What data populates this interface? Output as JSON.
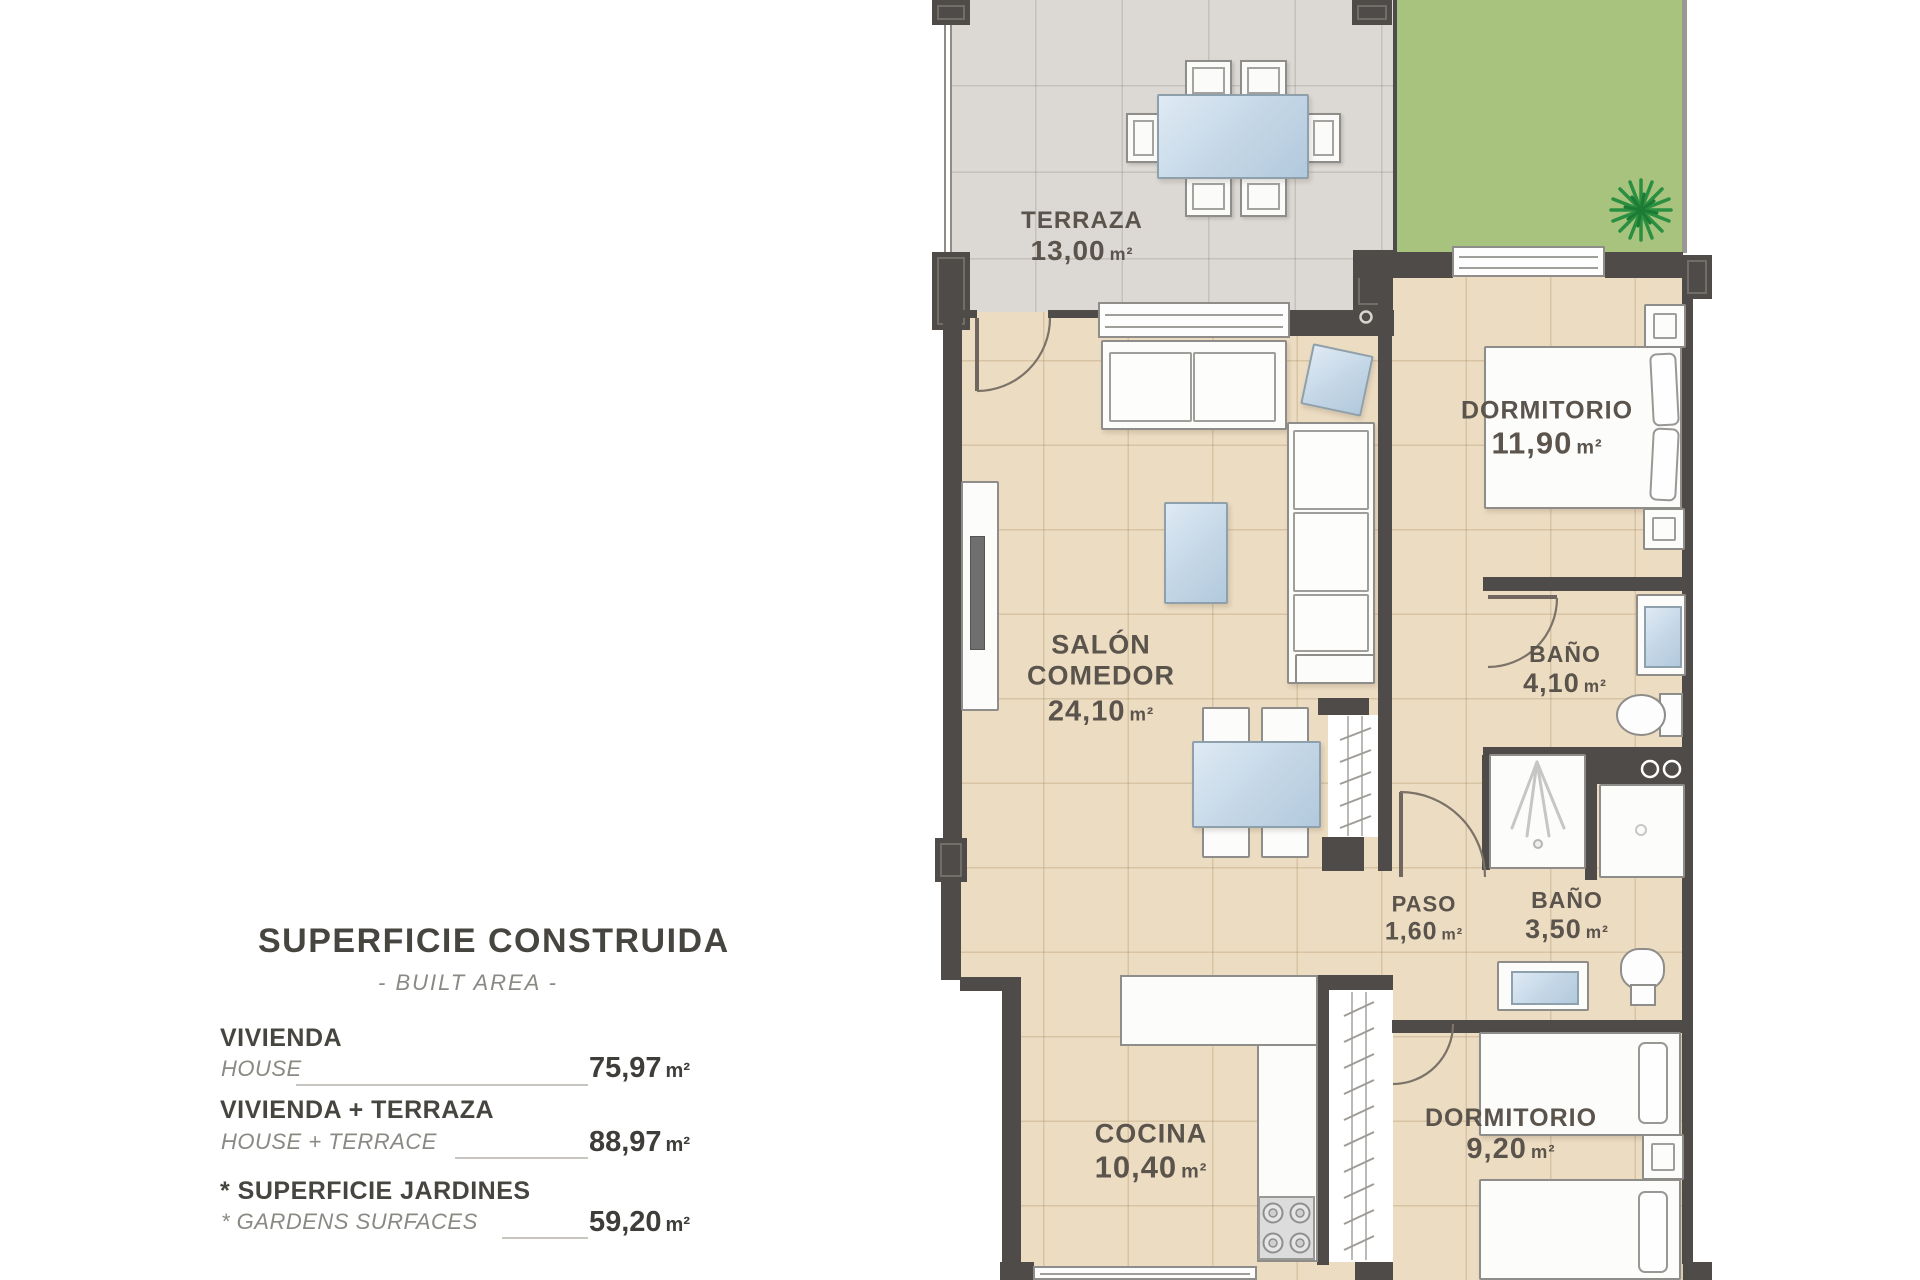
{
  "legend": {
    "title": "SUPERFICIE CONSTRUIDA",
    "subtitle": "- BUILT AREA -",
    "rows": [
      {
        "label_es": "VIVIENDA",
        "label_en": "HOUSE",
        "value": "75,97",
        "unit": "m²"
      },
      {
        "label_es": "VIVIENDA + TERRAZA",
        "label_en": "HOUSE + TERRACE",
        "value": "88,97",
        "unit": "m²"
      },
      {
        "label_es": "* SUPERFICIE JARDINES",
        "label_en": "* GARDENS SURFACES",
        "value": "59,20",
        "unit": "m²"
      }
    ]
  },
  "rooms": {
    "terraza": {
      "name": "TERRAZA",
      "area": "13,00",
      "unit": "m²"
    },
    "salon": {
      "name_line1": "SALÓN",
      "name_line2": "COMEDOR",
      "area": "24,10",
      "unit": "m²"
    },
    "dormitorio1": {
      "name": "DORMITORIO",
      "area": "11,90",
      "unit": "m²"
    },
    "bano1": {
      "name": "BAÑO",
      "area": "4,10",
      "unit": "m²"
    },
    "paso": {
      "name": "PASO",
      "area": "1,60",
      "unit": "m²"
    },
    "bano2": {
      "name": "BAÑO",
      "area": "3,50",
      "unit": "m²"
    },
    "dormitorio2": {
      "name": "DORMITORIO",
      "area": "9,20",
      "unit": "m²"
    },
    "cocina": {
      "name": "COCINA",
      "area": "10,40",
      "unit": "m²"
    }
  },
  "colors": {
    "wall": "#4e4b48",
    "floor": "#ecdcc2",
    "terrace": "#dcd8d3",
    "garden": "#a7c37d",
    "glass": "#c3d6e6",
    "label_text": "#5b544c"
  }
}
